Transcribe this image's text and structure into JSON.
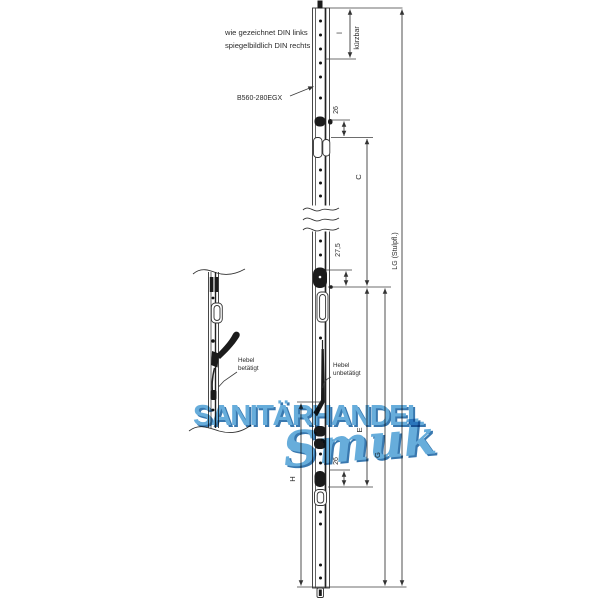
{
  "annotations": {
    "note_line1": "wie gezeichnet DIN links",
    "note_line2": "spiegelbildlich DIN rechts",
    "part_label": "B560-280EGX",
    "lever_actuated_line1": "Hebel",
    "lever_actuated_line2": "betätigt",
    "lever_idle_line1": "Hebel",
    "lever_idle_line2": "unbetätigt"
  },
  "dimensions": {
    "top_length": "l",
    "top_length_note": "kürzbar",
    "dim_26_upper": "26",
    "dim_c": "C",
    "dim_27_5": "27,5",
    "dim_lg": "LG (Stulpfl.)",
    "dim_e": "E",
    "dim_g": "G",
    "dim_26_lower": "26",
    "dim_h": "H"
  },
  "watermark": {
    "line1": "SANITÄRHANDEL",
    "line2": "Smuk",
    "fill_color": "#5FA9D9",
    "shadow_color": "#2E71AB"
  },
  "drawing": {
    "line_color": "#3c3c3c",
    "dark_fill": "#1b1b1b",
    "background": "#ffffff"
  }
}
